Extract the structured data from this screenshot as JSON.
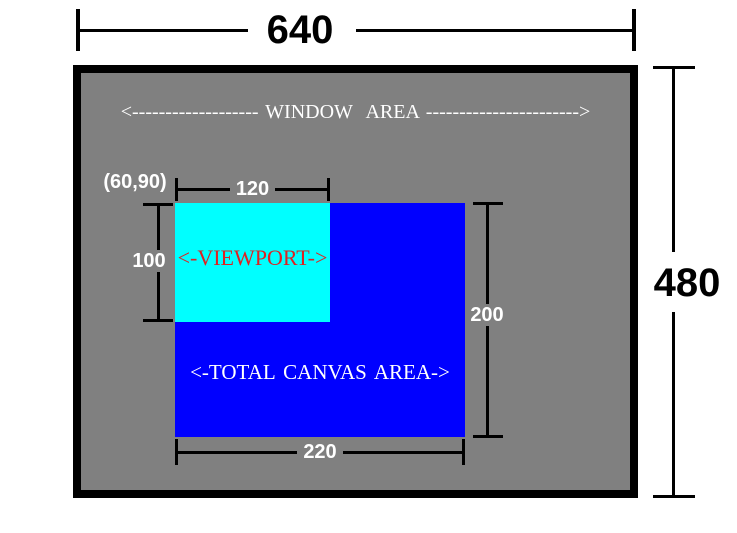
{
  "dimensions": {
    "window_width": "640",
    "window_height": "480",
    "canvas_width": "220",
    "canvas_height": "200",
    "viewport_width": "120",
    "viewport_height": "100",
    "viewport_origin": "(60,90)"
  },
  "labels": {
    "window_area": "<------------------- WINDOW  AREA ----------------------->",
    "canvas_area": "<-TOTAL CANVAS AREA->",
    "viewport": "<-VIEWPORT->"
  },
  "colors": {
    "page_background": "#ffffff",
    "window_fill": "#808080",
    "window_border": "#000000",
    "canvas_fill": "#0000ff",
    "viewport_fill": "#00ffff",
    "viewport_label_text": "#dd2222",
    "inner_dimension_text": "#ffffff",
    "inner_dimension_line": "#000000",
    "outer_dimension_text": "#000000",
    "outer_dimension_line": "#000000"
  }
}
